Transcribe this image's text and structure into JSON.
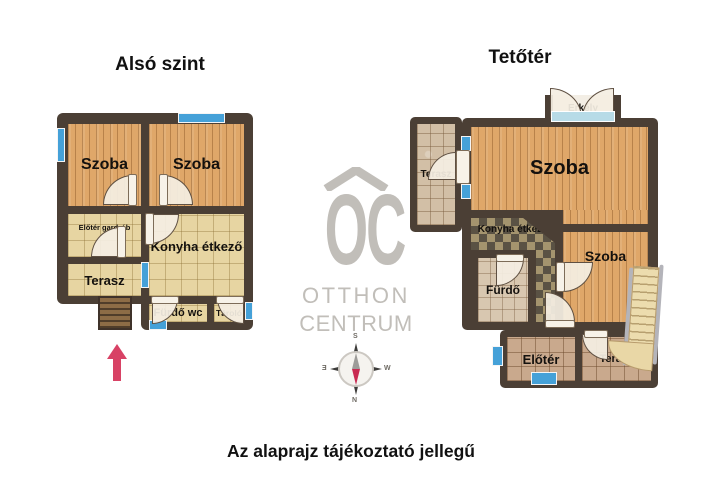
{
  "titles": {
    "left": "Alsó szint",
    "right": "Tetőtér"
  },
  "footer": "Az alaprajz tájékoztató jellegű",
  "left_plan": {
    "rooms": {
      "szoba_1": "Szoba",
      "szoba_2": "Szoba",
      "eloter_gardrob": "Előtér gardrób",
      "konyha_etkezo": "Konyha étkező",
      "terasz": "Terasz",
      "furdo_wc": "Fürdő wc",
      "tarolo": "Tároló"
    }
  },
  "right_plan": {
    "rooms": {
      "erkely": "Erkély",
      "terasz_felso": "Terasz",
      "szoba_nagy": "Szoba",
      "konyha_etkezo": "Konyha étkező",
      "szoba_kicsi": "Szoba",
      "furdo": "Fürdő",
      "eloter": "Előtér",
      "terasz_also": "Terasz"
    }
  },
  "logo": {
    "monogram": "OC",
    "name_line1": "OTTHON",
    "name_line2": "CENTRUM"
  },
  "compass": {
    "n": "N",
    "s": "S",
    "e": "E",
    "w": "W"
  },
  "colors": {
    "wall": "#4b3f35",
    "wood": "#dfa769",
    "tile_beige": "#e7d5a2",
    "tile_stone": "#d2bfa6",
    "tile_annex": "#c9a98d",
    "checker_dark": "#5a5244",
    "checker_light": "#a4946e",
    "window_blue": "#45a1d8",
    "balcony_glass": "#b7dbe7",
    "door_fill": "#f4eee2",
    "arrow_red": "#d84265",
    "logo_gray": "#c1beb9",
    "compass_needle_red": "#c92a52"
  }
}
